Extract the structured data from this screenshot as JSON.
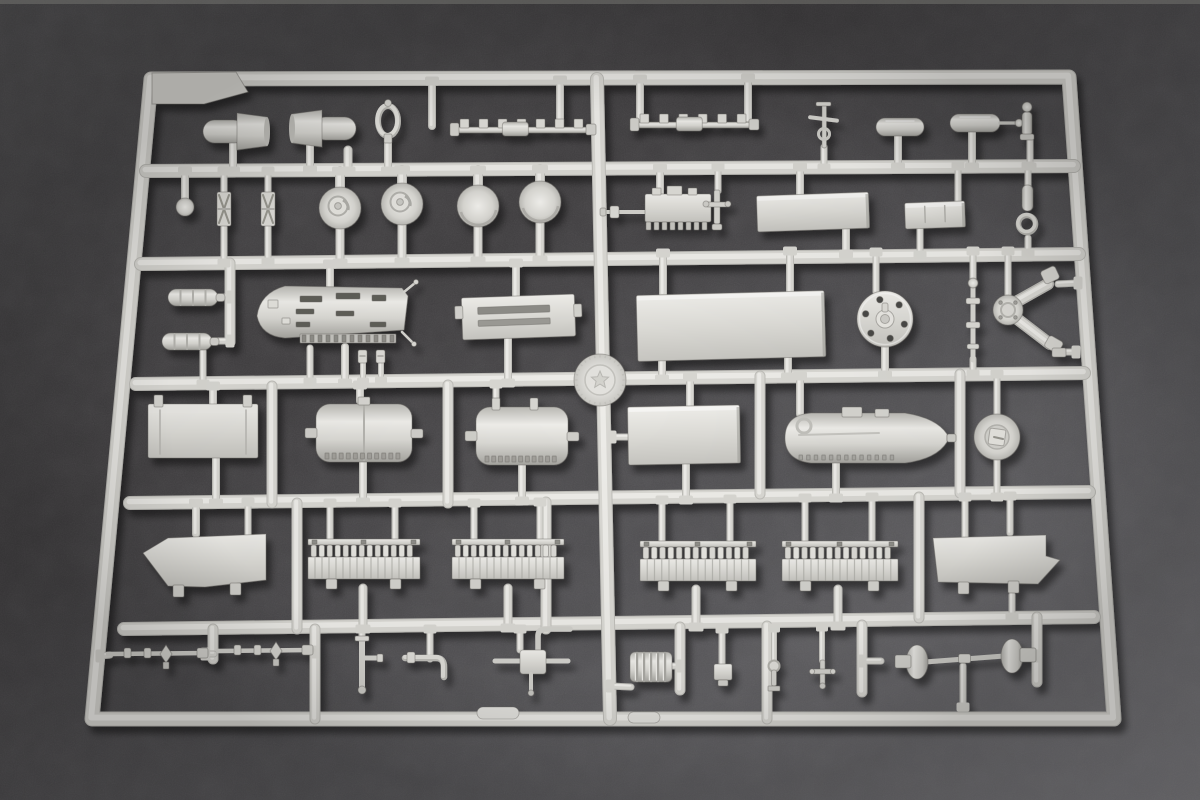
{
  "scene": {
    "width": 1200,
    "height": 800
  },
  "palette": {
    "felt_grad": [
      "#4a494b",
      "#403e40",
      "#555457",
      "#77767a"
    ],
    "top_edge_strip": "#8b8a85",
    "runner_shadowline": "#bfbeb9",
    "runner_base": "#d9d8d3",
    "runner_highlight": "#edece8",
    "plastic_hi": "#efeeea",
    "plastic_mid": "#dcdbd6",
    "plastic_base": "#d8d7d2",
    "plastic_lo": "#c6c5c0",
    "plastic_dark": "#a5a49f",
    "slot_dark": "#5f5e59",
    "tick_dark": "#8e8d88",
    "outline": "rgba(108,107,102,0.45)",
    "drop_shadow_opacity": 0.45
  },
  "frame": {
    "corners": [
      [
        151,
        79
      ],
      [
        1069,
        77
      ],
      [
        1114,
        719
      ],
      [
        92,
        719
      ]
    ],
    "width": 13,
    "gusset": [
      [
        152,
        73
      ],
      [
        236,
        72
      ],
      [
        248,
        92
      ],
      [
        204,
        104
      ],
      [
        152,
        104
      ]
    ]
  },
  "runner_width": 12,
  "runners": [
    [
      146,
      171,
      1074,
      166
    ],
    [
      141,
      264,
      1079,
      254
    ],
    [
      136,
      384,
      1084,
      373
    ],
    [
      130,
      503,
      1089,
      492
    ],
    [
      124,
      629,
      1094,
      617
    ],
    [
      597,
      79,
      610,
      719
    ]
  ],
  "divider_width": 9,
  "dividers": [
    [
      213,
      629,
      213,
      659
    ],
    [
      315,
      629,
      315,
      719
    ],
    [
      680,
      627,
      680,
      690
    ],
    [
      767,
      626,
      767,
      719
    ],
    [
      862,
      625,
      862,
      692
    ],
    [
      1037,
      617,
      1037,
      682
    ],
    [
      297,
      503,
      297,
      629
    ],
    [
      546,
      502,
      546,
      629
    ],
    [
      919,
      497,
      919,
      618
    ],
    [
      272,
      386,
      272,
      503
    ],
    [
      448,
      385,
      448,
      503
    ],
    [
      760,
      376,
      760,
      494
    ],
    [
      960,
      374,
      960,
      493
    ],
    [
      230,
      263,
      230,
      342
    ]
  ],
  "stems": [
    [
      233,
      171,
      233,
      144,
      6
    ],
    [
      310,
      170,
      310,
      142,
      6
    ],
    [
      348,
      171,
      348,
      150,
      7
    ],
    [
      388,
      171,
      388,
      138,
      6
    ],
    [
      432,
      81,
      432,
      126,
      6
    ],
    [
      560,
      80,
      560,
      128,
      6
    ],
    [
      640,
      79,
      640,
      119,
      6
    ],
    [
      748,
      78,
      748,
      121,
      6
    ],
    [
      824,
      168,
      824,
      147,
      5
    ],
    [
      898,
      167,
      898,
      135,
      6
    ],
    [
      972,
      167,
      972,
      132,
      6
    ],
    [
      1030,
      167,
      1030,
      138,
      5
    ],
    [
      185,
      171,
      185,
      199,
      6
    ],
    [
      224,
      171,
      224,
      194,
      5
    ],
    [
      224,
      263,
      224,
      227,
      5
    ],
    [
      268,
      171,
      268,
      194,
      5
    ],
    [
      268,
      262,
      268,
      227,
      5
    ],
    [
      340,
      171,
      340,
      189,
      8
    ],
    [
      340,
      263,
      340,
      228,
      7
    ],
    [
      402,
      170,
      402,
      185,
      8
    ],
    [
      402,
      262,
      402,
      224,
      7
    ],
    [
      478,
      170,
      478,
      187,
      8
    ],
    [
      478,
      261,
      478,
      226,
      7
    ],
    [
      540,
      169,
      540,
      183,
      8
    ],
    [
      540,
      260,
      540,
      222,
      7
    ],
    [
      660,
      168,
      660,
      196,
      6
    ],
    [
      718,
      167,
      718,
      191,
      5
    ],
    [
      800,
      167,
      800,
      196,
      6
    ],
    [
      846,
      254,
      846,
      229,
      6
    ],
    [
      958,
      166,
      958,
      203,
      5
    ],
    [
      920,
      255,
      920,
      227,
      5
    ],
    [
      1028,
      166,
      1028,
      186,
      5
    ],
    [
      1028,
      253,
      1028,
      238,
      5
    ],
    [
      230,
      297,
      218,
      297,
      5
    ],
    [
      230,
      341,
      213,
      341,
      5
    ],
    [
      203,
      384,
      203,
      351,
      5
    ],
    [
      330,
      264,
      330,
      288,
      6
    ],
    [
      345,
      383,
      345,
      347,
      6
    ],
    [
      310,
      382,
      310,
      348,
      5
    ],
    [
      363,
      382,
      363,
      363,
      4
    ],
    [
      381,
      381,
      381,
      363,
      4
    ],
    [
      516,
      263,
      516,
      297,
      6
    ],
    [
      508,
      383,
      508,
      339,
      6
    ],
    [
      663,
      253,
      663,
      294,
      6
    ],
    [
      790,
      251,
      790,
      292,
      6
    ],
    [
      662,
      379,
      662,
      358,
      6
    ],
    [
      788,
      377,
      788,
      357,
      6
    ],
    [
      876,
      252,
      876,
      292,
      5
    ],
    [
      885,
      375,
      885,
      346,
      6
    ],
    [
      973,
      251,
      973,
      284,
      5
    ],
    [
      973,
      374,
      973,
      359,
      5
    ],
    [
      1008,
      251,
      1008,
      295,
      5
    ],
    [
      1078,
      283,
      1058,
      284,
      5
    ],
    [
      1076,
      352,
      1056,
      352,
      5
    ],
    [
      213,
      386,
      213,
      406,
      6
    ],
    [
      216,
      503,
      216,
      457,
      6
    ],
    [
      360,
      385,
      360,
      401,
      6
    ],
    [
      363,
      502,
      363,
      461,
      6
    ],
    [
      496,
      384,
      496,
      399,
      5
    ],
    [
      522,
      501,
      522,
      464,
      6
    ],
    [
      690,
      377,
      690,
      407,
      6
    ],
    [
      686,
      500,
      686,
      463,
      6
    ],
    [
      612,
      437,
      629,
      437,
      5
    ],
    [
      800,
      376,
      800,
      414,
      6
    ],
    [
      836,
      498,
      836,
      461,
      6
    ],
    [
      997,
      374,
      997,
      415,
      5
    ],
    [
      997,
      497,
      997,
      459,
      5
    ],
    [
      196,
      503,
      196,
      534,
      6
    ],
    [
      248,
      502,
      248,
      536,
      5
    ],
    [
      330,
      503,
      330,
      540,
      5
    ],
    [
      395,
      503,
      395,
      540,
      5
    ],
    [
      363,
      629,
      363,
      588,
      7
    ],
    [
      474,
      503,
      474,
      540,
      5
    ],
    [
      540,
      502,
      540,
      540,
      5
    ],
    [
      508,
      628,
      508,
      588,
      7
    ],
    [
      662,
      500,
      662,
      542,
      5
    ],
    [
      730,
      499,
      730,
      542,
      5
    ],
    [
      696,
      627,
      696,
      589,
      7
    ],
    [
      805,
      498,
      805,
      542,
      5
    ],
    [
      872,
      497,
      872,
      542,
      5
    ],
    [
      838,
      626,
      838,
      589,
      7
    ],
    [
      1010,
      496,
      1010,
      533,
      5
    ],
    [
      965,
      497,
      965,
      537,
      5
    ],
    [
      1012,
      617,
      1012,
      595,
      5
    ],
    [
      100,
      656,
      110,
      655,
      5
    ],
    [
      205,
      654,
      214,
      654,
      5
    ],
    [
      315,
      652,
      310,
      651,
      5
    ],
    [
      362,
      629,
      362,
      640,
      5
    ],
    [
      430,
      629,
      430,
      659,
      5
    ],
    [
      520,
      629,
      520,
      650,
      5
    ],
    [
      610,
      686,
      631,
      687,
      5
    ],
    [
      680,
      666,
      671,
      666,
      5
    ],
    [
      722,
      629,
      722,
      665,
      5
    ],
    [
      774,
      628,
      774,
      661,
      4
    ],
    [
      822,
      627,
      822,
      661,
      4
    ],
    [
      862,
      661,
      881,
      661,
      5
    ],
    [
      963,
      707,
      963,
      666,
      5
    ],
    [
      1037,
      656,
      1029,
      656,
      5
    ]
  ],
  "ejector_tabs": [
    [
      477,
      707,
      42,
      12
    ],
    [
      628,
      712,
      32,
      11
    ]
  ],
  "logo": {
    "cx": 600,
    "cy": 380,
    "r": 26,
    "inner_r": 15,
    "star_r": 9
  },
  "parts": [
    {
      "name": "exhaust-funnel-a",
      "type": "funnel",
      "x": 203,
      "y": 120,
      "w": 42,
      "h": 23,
      "flip": false
    },
    {
      "name": "exhaust-funnel-b",
      "type": "funnel",
      "x": 300,
      "y": 117,
      "w": 42,
      "h": 23,
      "flip": true
    },
    {
      "name": "ring-loop",
      "type": "loop",
      "cx": 388,
      "cy": 121,
      "rx": 10,
      "ry": 15
    },
    {
      "name": "toothed-rail-a",
      "type": "rail",
      "x": 452,
      "y": 122,
      "len": 140,
      "teeth": 7
    },
    {
      "name": "toothed-rail-b",
      "type": "rail",
      "x": 632,
      "y": 117,
      "len": 123,
      "teeth": 6
    },
    {
      "name": "signal-mast",
      "type": "mast",
      "x": 824,
      "y": 102
    },
    {
      "name": "small-tank-a",
      "type": "capsule",
      "x": 876,
      "y": 118,
      "w": 48,
      "h": 18,
      "rod": 0
    },
    {
      "name": "small-tank-b",
      "type": "capsule",
      "x": 950,
      "y": 114,
      "w": 50,
      "h": 18,
      "rod": 16
    },
    {
      "name": "knob-post",
      "type": "knobpart",
      "x": 1022,
      "y": 108
    },
    {
      "name": "ball-knob",
      "type": "ball",
      "cx": 185,
      "cy": 207,
      "r": 9
    },
    {
      "name": "turnbuckle-a",
      "type": "twist",
      "x": 217,
      "y": 192,
      "w": 14,
      "h": 34
    },
    {
      "name": "turnbuckle-b",
      "type": "twist",
      "x": 261,
      "y": 192,
      "w": 14,
      "h": 34
    },
    {
      "name": "winch-drum-a",
      "type": "drum",
      "cx": 340,
      "cy": 208,
      "r": 21,
      "hub": true
    },
    {
      "name": "winch-drum-b",
      "type": "drum",
      "cx": 402,
      "cy": 204,
      "r": 21,
      "hub": true
    },
    {
      "name": "dome-drum-a",
      "type": "drum",
      "cx": 478,
      "cy": 206,
      "r": 21,
      "hub": false
    },
    {
      "name": "dome-drum-b",
      "type": "drum",
      "cx": 540,
      "cy": 202,
      "r": 21,
      "hub": false
    },
    {
      "name": "gun-breech",
      "type": "breech",
      "x": 645,
      "y": 194
    },
    {
      "name": "flat-plate-large",
      "type": "plate",
      "x": 757,
      "y": 194,
      "w": 112,
      "h": 36,
      "rot": -2,
      "ticks": 0
    },
    {
      "name": "flat-plate-small",
      "type": "plate",
      "x": 905,
      "y": 202,
      "w": 60,
      "h": 26,
      "rot": -2,
      "ticks": 2
    },
    {
      "name": "hook-fitting",
      "type": "hook",
      "x": 1022,
      "y": 185
    },
    {
      "name": "ribbed-cylinder-a",
      "type": "ribcyl",
      "x": 168,
      "y": 289,
      "w": 50,
      "h": 17
    },
    {
      "name": "ribbed-cylinder-b",
      "type": "ribcyl",
      "x": 162,
      "y": 333,
      "w": 50,
      "h": 17
    },
    {
      "name": "pontoon-hull",
      "type": "pontoon",
      "x": 255,
      "y": 286,
      "w": 153,
      "h": 60
    },
    {
      "name": "mini-clamp-a",
      "type": "minibit",
      "x": 358,
      "y": 350
    },
    {
      "name": "mini-clamp-b",
      "type": "minibit",
      "x": 376,
      "y": 350
    },
    {
      "name": "slotted-box",
      "type": "slotbox",
      "x": 462,
      "y": 296,
      "w": 113,
      "h": 42,
      "rot": -2
    },
    {
      "name": "deck-plate-xl",
      "type": "plate",
      "x": 637,
      "y": 293,
      "w": 188,
      "h": 66,
      "rot": -1.5,
      "ticks": 0
    },
    {
      "name": "bolt-flange-disc",
      "type": "flange",
      "cx": 885,
      "cy": 319,
      "r": 28
    },
    {
      "name": "control-rod",
      "type": "rodpart",
      "x": 970,
      "y": 283,
      "h": 77
    },
    {
      "name": "y-bracket-assembly",
      "type": "ybracket",
      "cx": 1008,
      "cy": 310
    },
    {
      "name": "stowage-box",
      "type": "tankbox",
      "x": 148,
      "y": 404,
      "w": 110,
      "h": 54
    },
    {
      "name": "muffler-a",
      "type": "muffler",
      "x": 316,
      "y": 404,
      "w": 96,
      "h": 58,
      "clips": 0,
      "seam": true
    },
    {
      "name": "muffler-b",
      "type": "muffler",
      "x": 476,
      "y": 407,
      "w": 92,
      "h": 58,
      "clips": 2,
      "seam": false
    },
    {
      "name": "long-box",
      "type": "plate",
      "x": 628,
      "y": 406,
      "w": 112,
      "h": 58,
      "rot": -1,
      "ticks": 0
    },
    {
      "name": "fuel-tank-pod",
      "type": "tankcapsule",
      "x": 787,
      "y": 413,
      "w": 118,
      "cone": 42,
      "h": 50
    },
    {
      "name": "wheel-cap",
      "type": "wheelcap",
      "cx": 997,
      "cy": 437,
      "r": 23
    },
    {
      "name": "bracket-wedge-left",
      "type": "wedge",
      "pts": [
        [
          143,
          553
        ],
        [
          168,
          538
        ],
        [
          266,
          534
        ],
        [
          266,
          580
        ],
        [
          205,
          587
        ],
        [
          168,
          586
        ]
      ],
      "feet": [
        [
          173,
          585
        ],
        [
          230,
          583
        ]
      ]
    },
    {
      "name": "track-comb-a",
      "type": "comb",
      "x": 308,
      "y": 539,
      "w": 112
    },
    {
      "name": "track-comb-b",
      "type": "comb",
      "x": 452,
      "y": 539,
      "w": 112
    },
    {
      "name": "track-comb-c",
      "type": "comb",
      "x": 640,
      "y": 541,
      "w": 116
    },
    {
      "name": "track-comb-d",
      "type": "comb",
      "x": 782,
      "y": 541,
      "w": 116
    },
    {
      "name": "bracket-wedge-right",
      "type": "wedge",
      "pts": [
        [
          933,
          538
        ],
        [
          1046,
          535
        ],
        [
          1046,
          556
        ],
        [
          1060,
          560
        ],
        [
          1038,
          584
        ],
        [
          938,
          582
        ]
      ],
      "feet": [
        [
          958,
          582
        ],
        [
          1008,
          581
        ]
      ]
    },
    {
      "name": "valve-rod-a",
      "type": "valverod",
      "x": 108,
      "y": 654,
      "len": 100
    },
    {
      "name": "valve-rod-b",
      "type": "valverod",
      "x": 218,
      "y": 651,
      "len": 95
    },
    {
      "name": "t-pipe",
      "type": "tpipe",
      "x": 362,
      "y": 638
    },
    {
      "name": "j-pipe",
      "type": "jpipe",
      "x": 405,
      "y": 658
    },
    {
      "name": "elbow-block",
      "type": "blockelbow",
      "x": 508,
      "y": 648
    },
    {
      "name": "bellows-cylinder",
      "type": "bellows",
      "x": 630,
      "y": 652,
      "w": 42,
      "h": 30
    },
    {
      "name": "pipe-fitting-block",
      "type": "fittingblock",
      "x": 714,
      "y": 664
    },
    {
      "name": "pipe-fitting-flange",
      "type": "fittingflange",
      "x": 768,
      "y": 662
    },
    {
      "name": "pipe-fitting-cross",
      "type": "fittingcross",
      "x": 814,
      "y": 660
    },
    {
      "name": "axle-dumbbell",
      "type": "dumbbell",
      "x1": 917,
      "y1": 662,
      "x2": 1012,
      "y2": 656
    }
  ]
}
